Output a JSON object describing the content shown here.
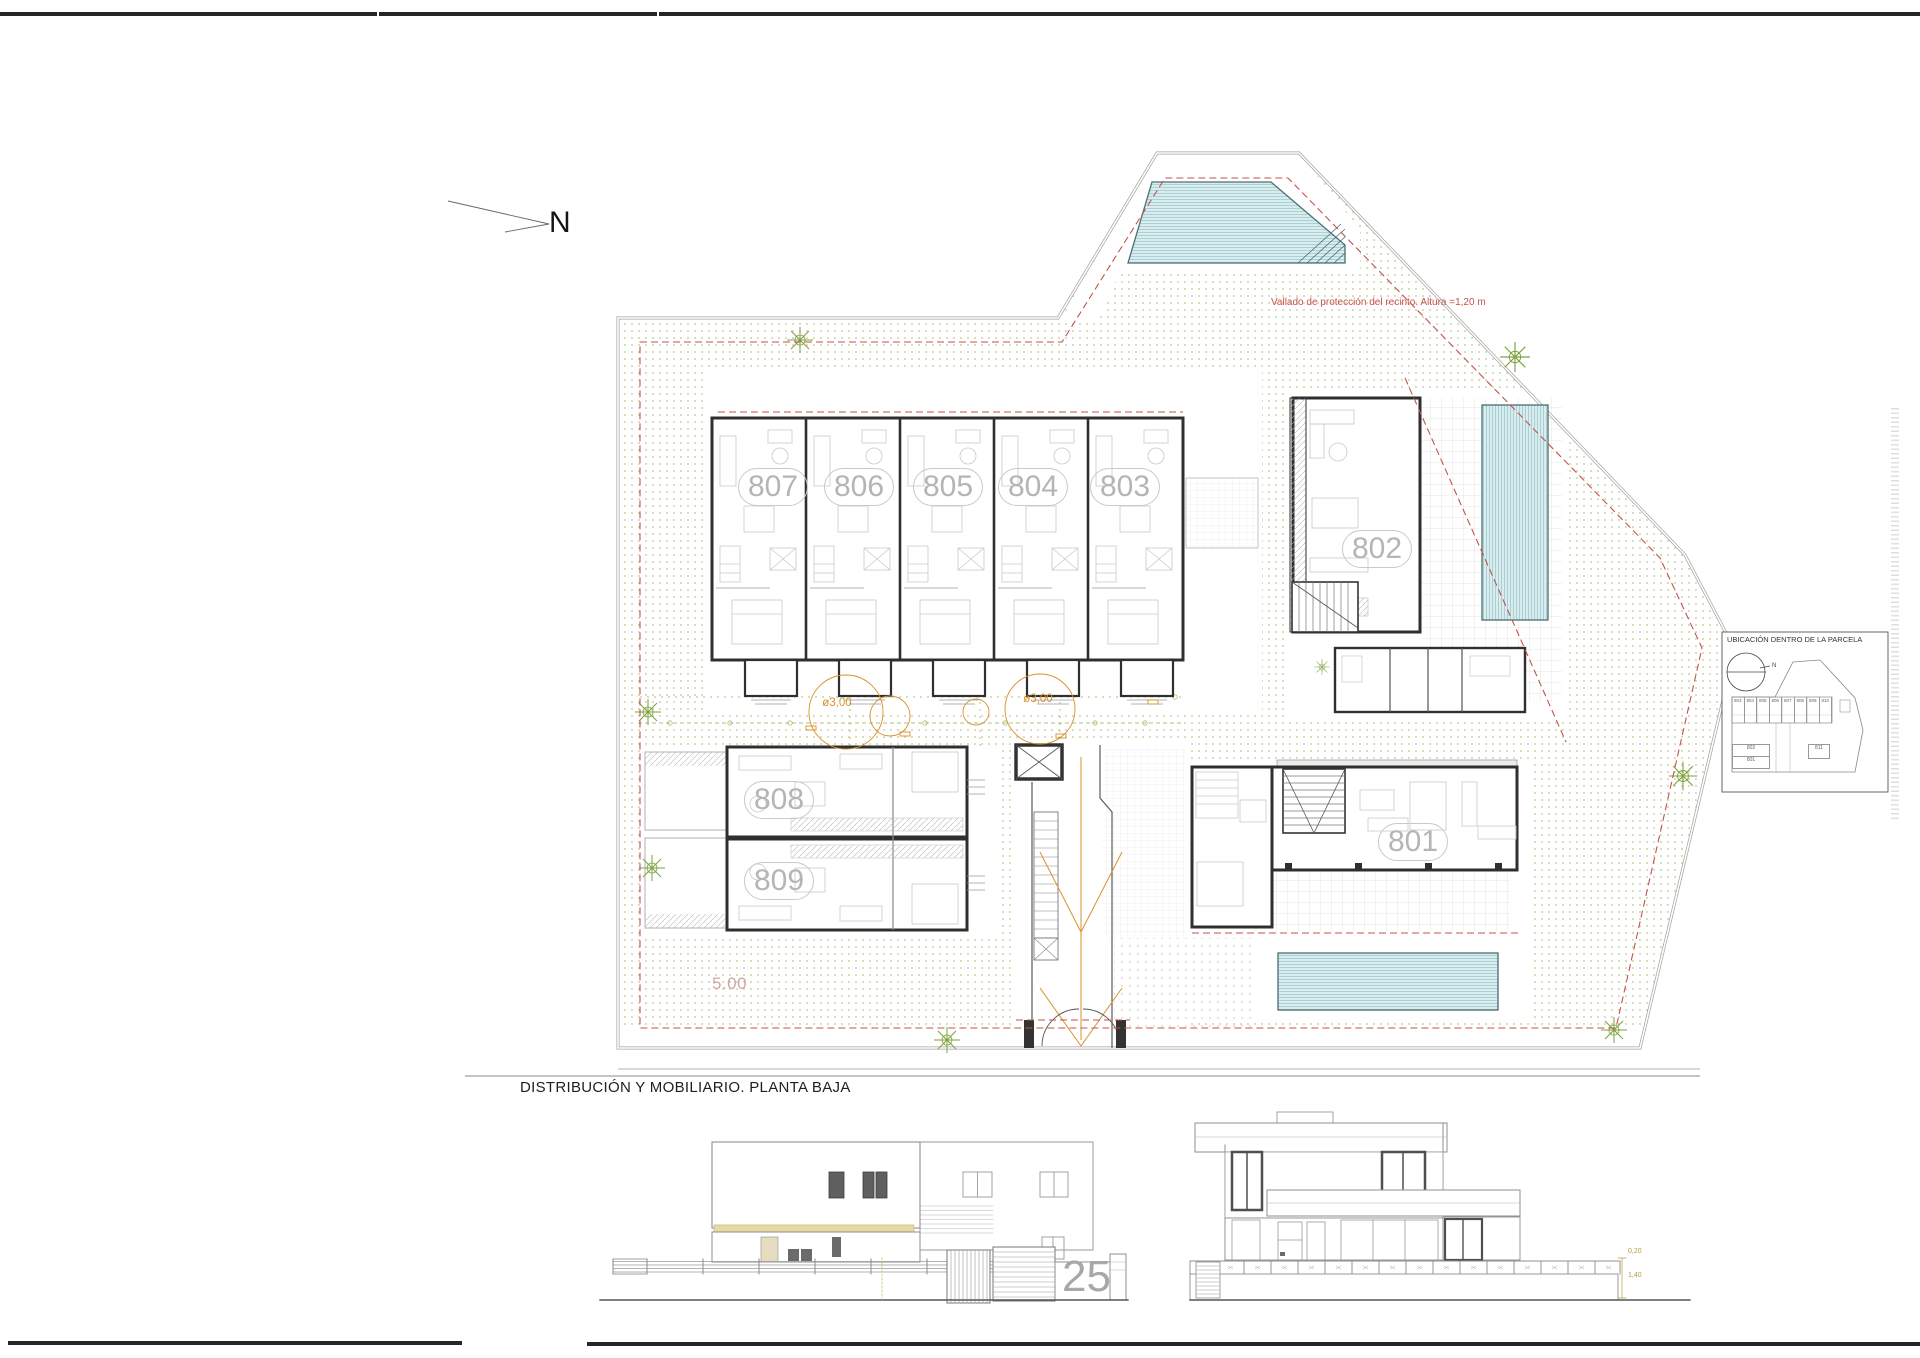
{
  "page": {
    "background": "#ffffff"
  },
  "north_arrow": {
    "label": "N"
  },
  "site_plan": {
    "fence_note": "Vallado de protección del recinto. Altura =1,20 m",
    "left_dimension": "5.00",
    "tree_labels": [
      {
        "text": "ø3,00"
      },
      {
        "text": "ø3,00"
      }
    ],
    "units": [
      {
        "label": "807"
      },
      {
        "label": "806"
      },
      {
        "label": "805"
      },
      {
        "label": "804"
      },
      {
        "label": "803"
      },
      {
        "label": "802"
      },
      {
        "label": "808"
      },
      {
        "label": "809"
      },
      {
        "label": "801"
      }
    ]
  },
  "legend_box": {
    "title": "UBICACIÓN DENTRO DE LA PARCELA",
    "north_label": "N",
    "row_units": [
      "803",
      "804",
      "805",
      "806",
      "807",
      "808",
      "809",
      "810"
    ],
    "stack_units": [
      "802",
      "801"
    ],
    "side_unit": "811"
  },
  "drawing": {
    "title": "DISTRIBUCIÓN Y MOBILIARIO. PLANTA BAJA"
  },
  "elevations": {
    "house_number": "25",
    "dim_top": "0,20",
    "dim_bottom": "1,40"
  },
  "colors": {
    "wall": "#2f2f2f",
    "red_dashed": "#c4524a",
    "orange": "#d8912c",
    "water_fill": "#d9edef",
    "water_line": "#9cc8cd",
    "green_dot": "#a9bd6b",
    "label_gray": "#b5b5b5",
    "yellow_band": "#e7d9a2",
    "tree_green": "#7da23e"
  }
}
